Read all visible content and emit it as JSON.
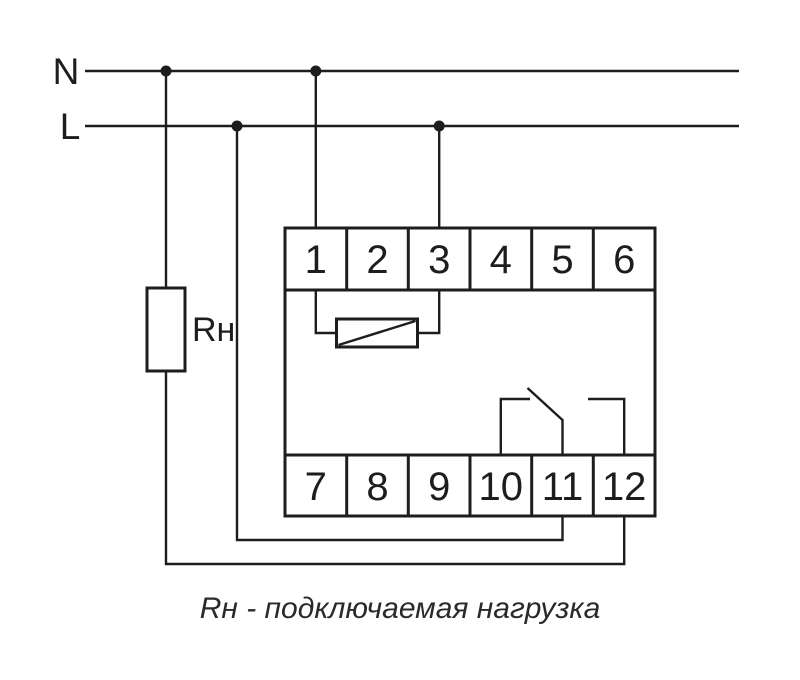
{
  "diagram": {
    "background": "#ffffff",
    "stroke_color": "#1d1d1b",
    "power_lines": {
      "neutral": {
        "label": "N"
      },
      "live": {
        "label": "L"
      }
    },
    "load": {
      "label": "Rн"
    },
    "device": {
      "top_terminals": [
        "1",
        "2",
        "3",
        "4",
        "5",
        "6"
      ],
      "bottom_terminals": [
        "7",
        "8",
        "9",
        "10",
        "11",
        "12"
      ]
    },
    "caption": "Rн - подключаемая нагрузка"
  }
}
